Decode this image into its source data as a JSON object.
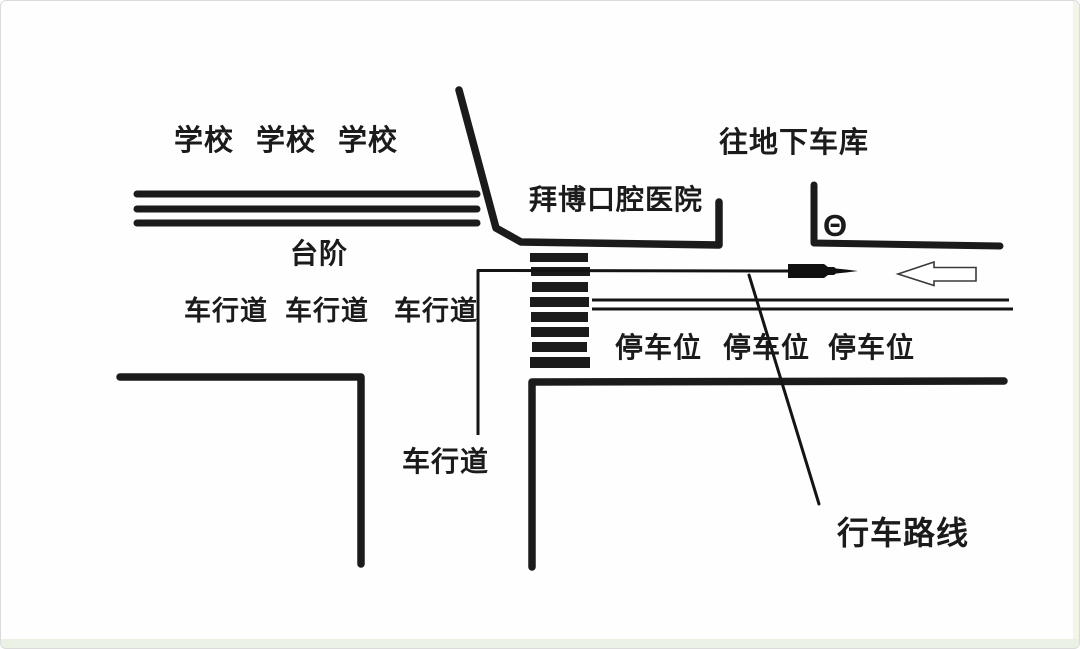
{
  "map": {
    "school_labels": [
      "学校",
      "学校",
      "学校"
    ],
    "steps_label": "台阶",
    "upper_roadway_labels": [
      "车行道",
      "车行道",
      "车行道"
    ],
    "hospital_label": "拜博口腔医院",
    "garage_label": "往地下车库",
    "garage_symbol": "Θ",
    "parking_labels": [
      "停车位",
      "停车位",
      "停车位"
    ],
    "lower_roadway_label": "车行道",
    "route_label": "行车路线",
    "colors": {
      "ink": "#1b1b1b",
      "background": "#fefefe",
      "block_arrow_outline": "#3a3a3a"
    },
    "icons": {
      "theta_garage_icon": "Θ",
      "route_arrowhead_icon": "filled-right-arrow",
      "left_block_arrow_icon": "hollow-left-arrow"
    }
  }
}
